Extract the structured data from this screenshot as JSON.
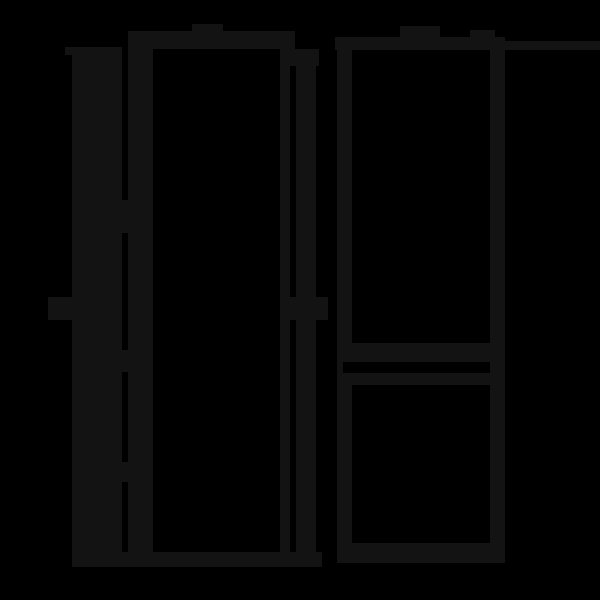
{
  "canvas": {
    "width": 600,
    "height": 600,
    "background": "#000000",
    "stroke_color": "#131313"
  },
  "figures": {
    "left_refrigerator_side_open_door": {
      "icon": "refrigerator-open-door-icon",
      "shapes": [
        {
          "name": "lf-door-top-cap",
          "x": 65,
          "y": 47,
          "w": 57,
          "h": 8
        },
        {
          "name": "lf-door-panel",
          "x": 72,
          "y": 55,
          "w": 50,
          "h": 497
        },
        {
          "name": "lf-door-handle",
          "x": 48,
          "y": 297,
          "w": 24,
          "h": 23
        },
        {
          "name": "lf-hinge-top",
          "x": 122,
          "y": 200,
          "w": 6,
          "h": 33
        },
        {
          "name": "lf-hinge-middle",
          "x": 122,
          "y": 350,
          "w": 6,
          "h": 22
        },
        {
          "name": "lf-hinge-bottom",
          "x": 122,
          "y": 462,
          "w": 6,
          "h": 20
        },
        {
          "name": "lf-left-wall",
          "x": 128,
          "y": 31,
          "w": 25,
          "h": 536
        },
        {
          "name": "lf-top-bar",
          "x": 128,
          "y": 31,
          "w": 167,
          "h": 18
        },
        {
          "name": "lf-top-tab",
          "x": 192,
          "y": 24,
          "w": 31,
          "h": 7
        },
        {
          "name": "lf-shoulder-step",
          "x": 280,
          "y": 49,
          "w": 39,
          "h": 17
        },
        {
          "name": "lf-inner-line",
          "x": 280,
          "y": 66,
          "w": 10,
          "h": 486
        },
        {
          "name": "lf-right-wall",
          "x": 296,
          "y": 66,
          "w": 20,
          "h": 486
        },
        {
          "name": "lf-right-handle",
          "x": 287,
          "y": 297,
          "w": 41,
          "h": 23
        },
        {
          "name": "lf-bottom-bar",
          "x": 72,
          "y": 552,
          "w": 250,
          "h": 15
        }
      ]
    },
    "right_refrigerator_front_two_doors": {
      "icon": "refrigerator-two-door-icon",
      "shapes": [
        {
          "name": "rf-top-tab-left",
          "x": 400,
          "y": 26,
          "w": 40,
          "h": 12
        },
        {
          "name": "rf-top-tab-right",
          "x": 470,
          "y": 30,
          "w": 25,
          "h": 8
        },
        {
          "name": "rf-top-bar",
          "x": 335,
          "y": 37,
          "w": 170,
          "h": 13
        },
        {
          "name": "rf-top-line-extension",
          "x": 505,
          "y": 41,
          "w": 95,
          "h": 9
        },
        {
          "name": "rf-left-wall",
          "x": 337,
          "y": 50,
          "w": 15,
          "h": 502
        },
        {
          "name": "rf-right-wall",
          "x": 490,
          "y": 50,
          "w": 15,
          "h": 502
        },
        {
          "name": "rf-upper-door-bottom-edge",
          "x": 352,
          "y": 343,
          "w": 138,
          "h": 19
        },
        {
          "name": "rf-door-gap-notch",
          "x": 343,
          "y": 362,
          "w": 9,
          "h": 11,
          "color": "bg"
        },
        {
          "name": "rf-lower-door-top-edge",
          "x": 352,
          "y": 373,
          "w": 138,
          "h": 12
        },
        {
          "name": "rf-bottom-bar",
          "x": 337,
          "y": 543,
          "w": 168,
          "h": 20
        }
      ]
    }
  }
}
